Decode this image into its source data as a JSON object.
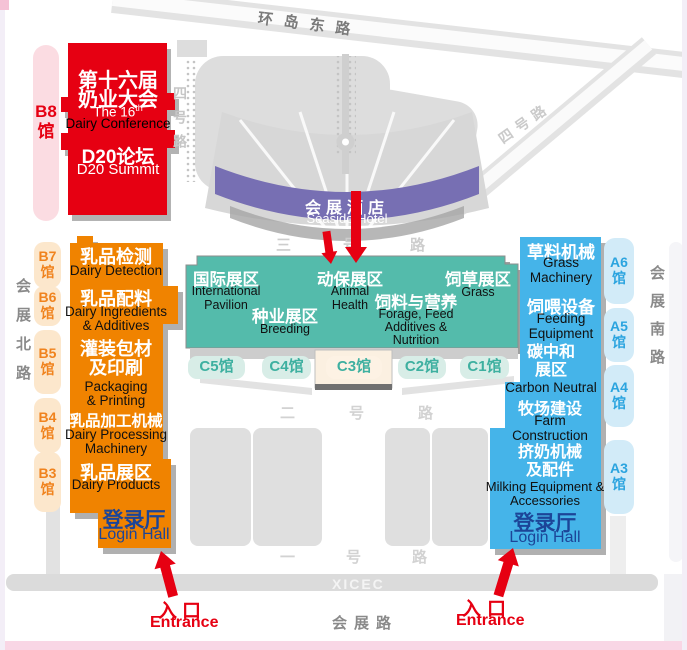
{
  "roads": {
    "ring_east": "环岛东路",
    "no4_left": "四号路",
    "no4_right": "四号路",
    "no3": "三号路",
    "no2": "二号路",
    "no1": "一号路",
    "north": "会展北路",
    "south": "会展南路",
    "exhibition": "会展路",
    "xicec": "XICEC"
  },
  "b8": {
    "hall_label": "B8\n馆",
    "title_zh_1": "第十六届",
    "title_zh_2": "奶业大会",
    "title_en_base": "The 16",
    "title_en_sup": "th",
    "title_en_2": "Dairy Conference",
    "d20_zh": "D20论坛",
    "d20_en": "D20 Summit"
  },
  "hotel": {
    "zh": "会展酒店",
    "en": "Seaside Hotel"
  },
  "west": {
    "sections": [
      {
        "zh": "乳品检测",
        "en": "Dairy Detection"
      },
      {
        "zh": "乳品配料",
        "en": "Dairy Ingredients\n& Additives"
      },
      {
        "zh": "灌装包材\n及印刷",
        "en": "Packaging\n& Printing"
      },
      {
        "zh": "乳品加工机械",
        "en": "Dairy Processing\nMachinery"
      },
      {
        "zh": "乳品展区",
        "en": "Dairy Products"
      }
    ],
    "login_zh": "登录厅",
    "login_en": "Login Hall",
    "halls": [
      {
        "label": "B7\n馆"
      },
      {
        "label": "B6\n馆"
      },
      {
        "label": "B5\n馆"
      },
      {
        "label": "B4\n馆"
      },
      {
        "label": "B3\n馆"
      }
    ]
  },
  "center": {
    "zones": [
      {
        "zh": "国际展区",
        "en": "International\nPavilion"
      },
      {
        "zh": "种业展区",
        "en": "Breeding"
      },
      {
        "zh": "动保展区",
        "en": "Animal\nHealth"
      },
      {
        "zh": "饲料与营养",
        "en": "Forage, Feed\nAdditives &\nNutrition"
      },
      {
        "zh": "饲草展区",
        "en": "Grass"
      }
    ],
    "halls": [
      {
        "label": "C5馆"
      },
      {
        "label": "C4馆"
      },
      {
        "label": "C3馆"
      },
      {
        "label": "C2馆"
      },
      {
        "label": "C1馆"
      }
    ]
  },
  "east": {
    "sections": [
      {
        "zh": "草料机械",
        "en": "Grass\nMachinery"
      },
      {
        "zh": "饲喂设备",
        "en": "Feeding\nEquipment"
      },
      {
        "zh": "碳中和\n展区",
        "en": "Carbon Neutral"
      },
      {
        "zh": "牧场建设",
        "en": "Farm\nConstruction"
      },
      {
        "zh": "挤奶机械\n及配件",
        "en": "Milking Equipment &\nAccessories"
      }
    ],
    "login_zh": "登录厅",
    "login_en": "Login Hall",
    "halls": [
      {
        "label": "A6\n馆"
      },
      {
        "label": "A5\n馆"
      },
      {
        "label": "A4\n馆"
      },
      {
        "label": "A3\n馆"
      }
    ]
  },
  "entrance_left": {
    "zh": "入口",
    "en": "Entrance"
  },
  "entrance_right": {
    "zh": "入口",
    "en": "Entrance"
  },
  "colors": {
    "red": "#E60012",
    "orange": "#F08300",
    "teal": "#54BBAB",
    "blue": "#45B4E9",
    "purple": "#776FB3",
    "login_blue": "#1C4598",
    "cream": "#FBF0E1"
  }
}
